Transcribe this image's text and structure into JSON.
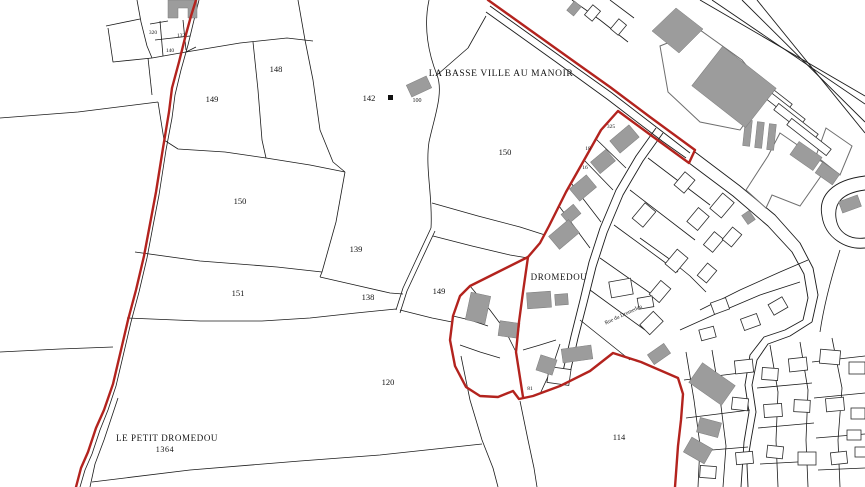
{
  "map": {
    "type": "cadastral-map",
    "canvas": {
      "width": 865,
      "height": 487
    },
    "colors": {
      "background": "#ffffff",
      "parcel_line": "#1b1b1b",
      "zone_boundary_red": "#b3231e",
      "building_gray": "#9c9c9c",
      "building_outline": "#6e6e6e"
    },
    "place_labels": [
      {
        "t": "LA BASSE VILLE AU MANOIR",
        "x": 501,
        "y": 76,
        "s": 9.5
      },
      {
        "t": "DROMEDOU",
        "x": 559,
        "y": 280,
        "s": 9
      },
      {
        "t": "LE PETIT DROMEDOU",
        "x": 167,
        "y": 441,
        "s": 9
      },
      {
        "t": "1364",
        "x": 165,
        "y": 452,
        "s": 8
      }
    ],
    "street_labels": [
      {
        "t": "Rue du Dromedou",
        "x": 624,
        "y": 316,
        "s": 5.5,
        "r": -25
      }
    ],
    "parcel_numbers": [
      {
        "t": "148",
        "x": 276,
        "y": 72,
        "s": 8.5
      },
      {
        "t": "149",
        "x": 212,
        "y": 102,
        "s": 8.5
      },
      {
        "t": "142",
        "x": 369,
        "y": 101,
        "s": 8.5
      },
      {
        "t": "150",
        "x": 505,
        "y": 155,
        "s": 8.5
      },
      {
        "t": "150",
        "x": 240,
        "y": 204,
        "s": 8.5
      },
      {
        "t": "139",
        "x": 356,
        "y": 252,
        "s": 8.5
      },
      {
        "t": "151",
        "x": 238,
        "y": 296,
        "s": 8.5
      },
      {
        "t": "138",
        "x": 368,
        "y": 300,
        "s": 8.5
      },
      {
        "t": "149",
        "x": 439,
        "y": 294,
        "s": 8.5
      },
      {
        "t": "120",
        "x": 388,
        "y": 385,
        "s": 8.5
      },
      {
        "t": "114",
        "x": 619,
        "y": 440,
        "s": 8.5
      },
      {
        "t": "100",
        "x": 417,
        "y": 102,
        "s": 6
      },
      {
        "t": "320",
        "x": 153,
        "y": 34,
        "s": 5.5
      },
      {
        "t": "132",
        "x": 181,
        "y": 37,
        "s": 5.5
      },
      {
        "t": "140",
        "x": 170,
        "y": 52,
        "s": 5.5
      },
      {
        "t": "325",
        "x": 611,
        "y": 128,
        "s": 5.5
      },
      {
        "t": "18",
        "x": 588,
        "y": 150,
        "s": 5.5
      },
      {
        "t": "16",
        "x": 585,
        "y": 169,
        "s": 5.5
      },
      {
        "t": "81",
        "x": 530,
        "y": 390,
        "s": 5.5
      }
    ],
    "red_boundaries": [
      "M196,0 L191,16 L185,38 L179,62 L172,88 L169,112 L163,148 L156,192 L150,224 L144,256 L136,290 L128,320 L121,350 L113,384 L104,410 L96,428 L88,452 L81,468 L76,487",
      "M488,0 L530,30 L572,60 L610,87 L650,117 L695,150 L689,163 L652,136 L618,111 L601,130 L583,162 L566,192 L549,226 L540,243 L528,257 L498,272 L470,286 L460,296 L453,316 L450,340 L455,366 L466,387 L480,396 L498,397 L513,391 L519,399 L533,396 L560,386 L590,371 L613,353 L641,362 L678,378 L683,394 L681,420 L678,446 L675,487",
      "M528,257 L523,292 L519,322 L516,352 L523,397"
    ],
    "parcel_lines": [
      "M137,0 L141,22 L147,46 L152,58",
      "M106,26 L140,19",
      "M108,28 L113,62 L152,58",
      "M152,58 L186,52 L196,47",
      "M150,24 L168,21",
      "M155,40 L190,36",
      "M160,21 L163,56",
      "M183,20 L186,50",
      "M148,58 L152,95",
      "M186,52 L240,43 L287,38 L313,41",
      "M298,0 L305,40 L313,80 L320,130 L333,162 L345,172",
      "M253,42 L258,90 L262,140 L266,158",
      "M0,118 L78,112 L158,102",
      "M158,102 L164,140 L178,149 L225,152 L266,158 L310,165 L345,172",
      "M135,252 L200,261 L277,267 L322,272",
      "M345,172 L336,222 L322,272 L320,277",
      "M320,277 L355,285 L390,293 L403,294",
      "M127,318 L200,321 L262,321 L310,318 L356,313 L396,309",
      "M0,352 L60,349 L113,347",
      "M118,398 L104,440 L95,464 L90,487",
      "M92,482 L190,470 L300,461 L380,455 L482,444",
      "M461,356 L470,400 L482,440 L493,468 L498,487",
      "M429,0 C423,28 429,55 437,75 C444,93 434,118 429,142 C425,168 433,198 431,228",
      "M431,228 L416,260 L403,288 L396,310",
      "M435,231 L420,263 L407,291 L400,313",
      "M432,203 L478,216 L520,227 L545,235",
      "M433,236 L472,246 L510,255 L528,258",
      "M400,310 L432,318 L452,322",
      "M437,75 L468,48 L486,16",
      "M199,0 L194,20 L188,45 L181,70 L175,95 L172,118 L166,150 L159,195 L153,226 L147,258 L139,292 L131,322 L124,352 L116,386 L108,410 L100,430 L92,454 L85,470 L80,487",
      "M596,139 L626,168",
      "M584,160 L613,190",
      "M571,183 L601,222",
      "M559,206 L590,248",
      "M648,158 L710,205",
      "M630,190 L695,240",
      "M614,225 L678,272",
      "M600,258 L660,300",
      "M590,290 L645,330",
      "M580,320 L630,360",
      "M470,286 L490,310 L505,330 L516,352",
      "M453,316 L470,320 L488,326",
      "M460,345 L480,352 L500,358",
      "M523,350 L540,345 L556,340",
      "M540,394 L552,368 L560,344",
      "M520,401 L528,440 L534,468 L537,487",
      "M572,0 L600,20 L628,42",
      "M610,0 L634,18",
      "M686,352 L694,400 L700,445 L698,487",
      "M712,350 L720,398 L726,446 L723,487",
      "M770,345 L778,392 L776,440 L778,487",
      "M800,342 L808,390 L806,440 L808,487",
      "M832,338 L842,388 L838,440 L840,487",
      "M684,380 L748,372",
      "M686,418 L750,410",
      "M688,452 L748,447",
      "M757,388 L812,383",
      "M758,428 L814,423",
      "M760,464 L816,461",
      "M812,362 L865,356",
      "M814,398 L865,393",
      "M816,438 L865,434",
      "M818,470 L865,468",
      "M700,310 L740,290 L780,272 L808,260",
      "M680,330 L720,312 L760,295 L800,282",
      "M640,238 L668,258 L690,276 L706,292",
      "M840,250 C832,275 824,305 820,332"
    ],
    "road_lines": [
      "M490,6 L560,56 L612,93 L668,136 L690,153",
      "M486,12 L556,62 L607,99 L662,141 L686,158",
      "M695,152 L740,186 L775,215 L800,243 L813,268 L818,295 L812,322",
      "M689,163 L733,196 L768,226 L792,252 L804,274 L808,298 L803,320",
      "M812,322 L790,336 L768,344 L757,360 L752,385 L756,412 L751,440 L747,465 L748,487",
      "M803,320 L785,330 L764,337 L750,355 L745,385 L749,412 L744,442 L741,487",
      "M700,0 L865,96",
      "M712,0 L865,104",
      "M742,0 L865,122",
      "M757,0 L865,133",
      "M865,176 C832,180 818,196 822,216 C825,238 846,250 865,248",
      "M865,190 C842,193 834,203 836,218 C838,233 850,240 865,238",
      "M656,128 L636,156 L616,190 L600,228 L589,262 L580,300 L571,336 L561,380",
      "M663,133 L643,161 L623,195 L607,233 L596,267 L587,303 L578,338 L568,382"
    ],
    "outline_buildings": [
      "660,46 700,30 742,60 768,92 740,130 700,122 668,92",
      "780,133 828,166 800,206 772,195 766,208 746,190 768,156",
      "826,128 852,146 840,175 816,156"
    ],
    "gray_buildings_poly": [
      "168,0 197,0 197,18 188,18 188,8 178,8 178,18 168,18",
      "676,8 703,29 679,53 652,31"
    ],
    "gray_buildings_rect": [
      [
        408,
        80,
        22,
        13,
        -25
      ],
      [
        612,
        131,
        25,
        16,
        -40
      ],
      [
        593,
        154,
        20,
        15,
        -40
      ],
      [
        572,
        180,
        22,
        16,
        -40
      ],
      [
        563,
        208,
        16,
        12,
        -40
      ],
      [
        551,
        226,
        26,
        17,
        -40
      ],
      [
        468,
        294,
        20,
        28,
        12
      ],
      [
        499,
        322,
        20,
        15,
        8
      ],
      [
        527,
        292,
        24,
        16,
        -4
      ],
      [
        555,
        294,
        13,
        11,
        -4
      ],
      [
        562,
        347,
        30,
        14,
        -8
      ],
      [
        538,
        357,
        17,
        16,
        18
      ],
      [
        649,
        348,
        20,
        12,
        -35
      ],
      [
        692,
        372,
        40,
        24,
        35
      ],
      [
        698,
        420,
        22,
        15,
        15
      ],
      [
        686,
        442,
        24,
        17,
        30
      ],
      [
        744,
        212,
        9,
        11,
        -35
      ],
      [
        744,
        120,
        7,
        26,
        6
      ],
      [
        756,
        122,
        7,
        26,
        6
      ],
      [
        768,
        124,
        7,
        26,
        6
      ],
      [
        792,
        148,
        28,
        16,
        35
      ],
      [
        817,
        167,
        21,
        13,
        35
      ],
      [
        840,
        198,
        20,
        12,
        -20
      ],
      [
        700,
        62,
        68,
        50,
        38
      ],
      [
        568,
        4,
        12,
        9,
        -50
      ]
    ],
    "white_buildings_rect": [
      [
        634,
        208,
        20,
        14,
        -50
      ],
      [
        676,
        176,
        17,
        13,
        -50
      ],
      [
        689,
        212,
        18,
        14,
        -50
      ],
      [
        712,
        198,
        20,
        15,
        -50
      ],
      [
        705,
        236,
        17,
        12,
        -50
      ],
      [
        667,
        254,
        19,
        14,
        -50
      ],
      [
        651,
        285,
        18,
        13,
        -50
      ],
      [
        642,
        316,
        19,
        14,
        -45
      ],
      [
        699,
        267,
        16,
        12,
        -50
      ],
      [
        724,
        231,
        16,
        12,
        -50
      ],
      [
        712,
        300,
        16,
        12,
        -20
      ],
      [
        742,
        316,
        17,
        12,
        -20
      ],
      [
        770,
        300,
        16,
        12,
        -30
      ],
      [
        700,
        328,
        15,
        11,
        -15
      ],
      [
        735,
        360,
        18,
        13,
        -6
      ],
      [
        762,
        368,
        16,
        12,
        4
      ],
      [
        789,
        358,
        18,
        13,
        -6
      ],
      [
        820,
        350,
        20,
        14,
        5
      ],
      [
        849,
        362,
        16,
        12,
        0
      ],
      [
        732,
        398,
        16,
        12,
        6
      ],
      [
        764,
        404,
        18,
        13,
        -4
      ],
      [
        794,
        400,
        16,
        12,
        3
      ],
      [
        826,
        398,
        18,
        13,
        -5
      ],
      [
        851,
        408,
        14,
        11,
        0
      ],
      [
        736,
        452,
        17,
        12,
        -5
      ],
      [
        767,
        446,
        16,
        12,
        6
      ],
      [
        798,
        452,
        18,
        13,
        0
      ],
      [
        831,
        452,
        16,
        12,
        -6
      ],
      [
        855,
        447,
        12,
        10,
        0
      ],
      [
        700,
        466,
        16,
        12,
        4
      ],
      [
        847,
        430,
        14,
        10,
        0
      ],
      [
        610,
        280,
        22,
        16,
        -10
      ],
      [
        638,
        297,
        15,
        11,
        -10
      ],
      [
        548,
        368,
        22,
        16,
        8
      ],
      [
        586,
        8,
        13,
        10,
        -50
      ],
      [
        612,
        22,
        13,
        10,
        -50
      ],
      [
        745,
        88,
        50,
        8,
        38
      ],
      [
        758,
        103,
        50,
        8,
        38
      ],
      [
        771,
        118,
        50,
        8,
        38
      ],
      [
        784,
        133,
        50,
        8,
        38
      ]
    ],
    "marks": [
      [
        388,
        95,
        5,
        5
      ]
    ]
  }
}
